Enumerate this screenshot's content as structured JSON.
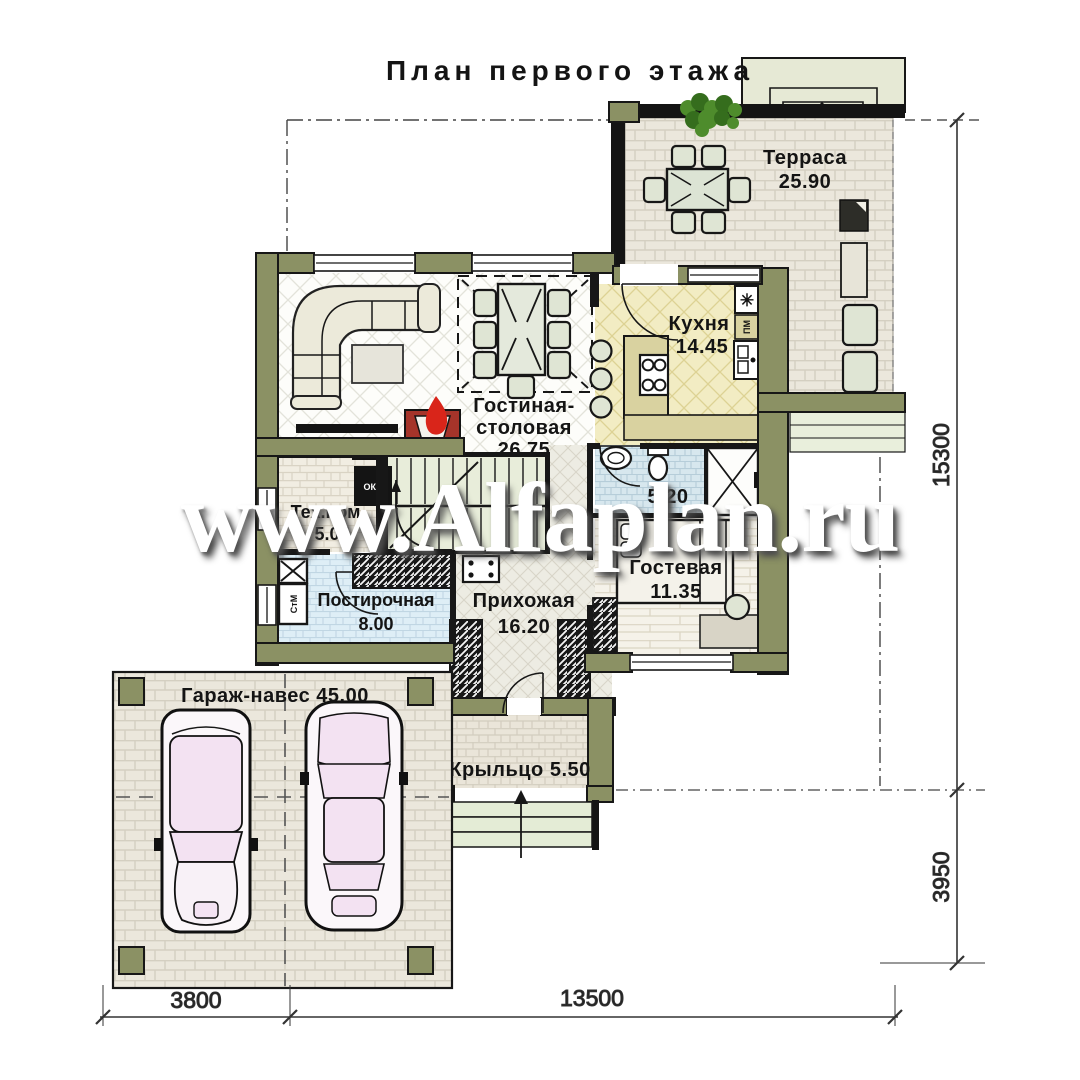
{
  "title": "План первого этажа",
  "watermark": "www.Alfaplan.ru",
  "rooms": {
    "terrace": {
      "name": "Терраса",
      "area": "25.90"
    },
    "kitchen": {
      "name": "Кухня",
      "area": "14.45"
    },
    "living": {
      "name_line1": "Гостиная-",
      "name_line2": "столовая",
      "area": "26.75"
    },
    "tech": {
      "name": "Тех.пом.",
      "area": "5.05"
    },
    "laundry": {
      "name": "Постирочная",
      "area": "8.00"
    },
    "hall": {
      "name": "Прихожая",
      "area": "16.20"
    },
    "bath": {
      "area": "5.20"
    },
    "guest": {
      "name": "Гостевая",
      "area": "11.35"
    },
    "garage": {
      "label": "Гараж-навес 45.00"
    },
    "porch": {
      "label": "Крыльцо 5.50"
    }
  },
  "appliances": {
    "washer": "СтМ",
    "boiler": "ОКБ",
    "dishwasher": "ПМ",
    "vent_symbol": "✳"
  },
  "dimensions": {
    "right_upper": "15300",
    "right_lower": "3950",
    "bottom_left": "3800",
    "bottom_right": "13500"
  },
  "colors": {
    "wall_olive": "#8b9164",
    "terrace_floor": "#ebe7dc",
    "kitchen_floor": "#f2ecc3",
    "bath_floor": "#d7e7ee",
    "laundry_floor": "#deeef6",
    "stair_floor": "#e8edda",
    "car_glass": "#f3e2f2",
    "fireplace": "#a5342a",
    "flame": "#d9251a",
    "plant": "#4e8c2c"
  }
}
